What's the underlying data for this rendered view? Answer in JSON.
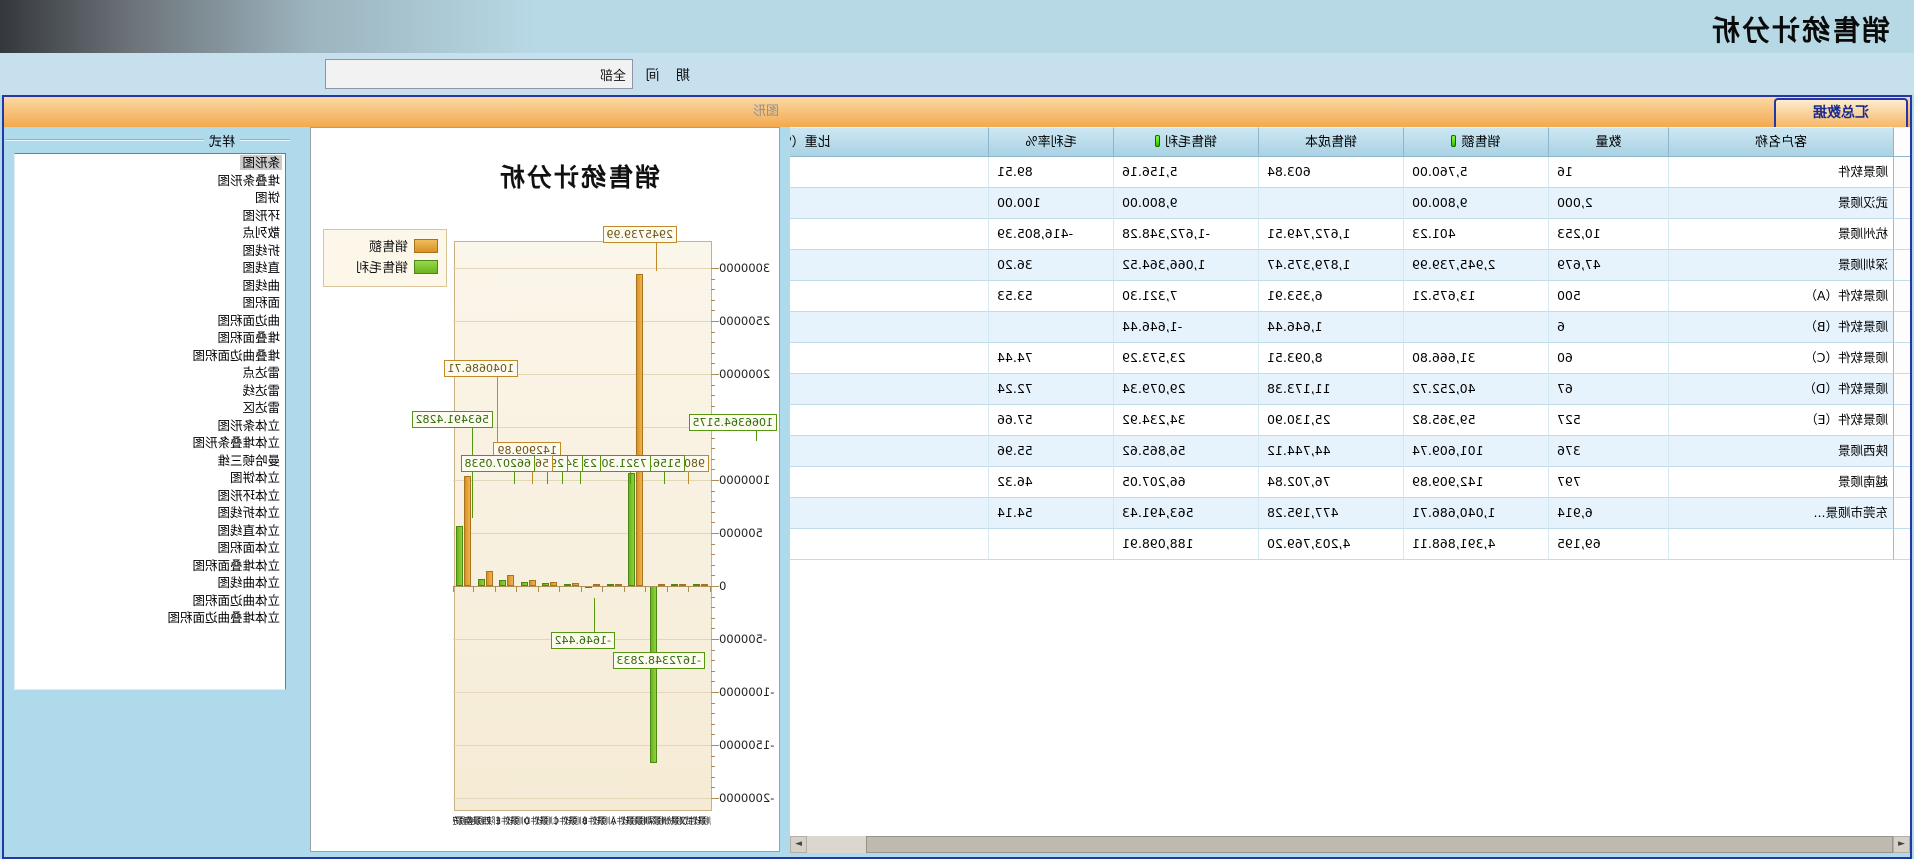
{
  "window": {
    "title": "销售统计分析"
  },
  "toolbar": {
    "period_label": "期 间",
    "period_value": "全部"
  },
  "tabs": {
    "active": "汇总数据",
    "disabled": "图形"
  },
  "scrollbar": {
    "left_arrow": "◄",
    "right_arrow": "►"
  },
  "table": {
    "columns": [
      {
        "label": "客户名称",
        "icon": false
      },
      {
        "label": "数量",
        "icon": false
      },
      {
        "label": "销售额",
        "icon": true
      },
      {
        "label": "销售成本",
        "icon": false
      },
      {
        "label": "销售毛利",
        "icon": true
      },
      {
        "label": "毛利率%",
        "icon": false
      },
      {
        "label": "比重（%）",
        "icon": false
      }
    ],
    "rows": [
      [
        "顺景软件",
        "16",
        "5,760.00",
        "603.84",
        "5,156.16",
        "89.51",
        ""
      ],
      [
        "武汉顺景",
        "2,000",
        "9,800.00",
        "",
        "9,800.00",
        "100.00",
        ""
      ],
      [
        "杭州顺景",
        "10,253",
        "401.23",
        "1,672,749.51",
        "-1,672,348.28",
        "-416,805.39",
        ""
      ],
      [
        "深圳顺景",
        "47,679",
        "2,945,739.99",
        "1,879,375.47",
        "1,066,364.52",
        "36.20",
        ""
      ],
      [
        "顺景软件（A）",
        "500",
        "13,675.21",
        "6,353.91",
        "7,321.30",
        "53.53",
        ""
      ],
      [
        "顺景软件（B）",
        "6",
        "",
        "1,646.44",
        "-1,646.44",
        "",
        ""
      ],
      [
        "顺景软件（C）",
        "60",
        "31,666.80",
        "8,093.51",
        "23,573.29",
        "74.44",
        ""
      ],
      [
        "顺景软件（D）",
        "67",
        "40,252.72",
        "11,173.38",
        "29,079.34",
        "72.24",
        ""
      ],
      [
        "顺景软件（E）",
        "527",
        "59,365.82",
        "25,130.90",
        "34,234.92",
        "57.66",
        ""
      ],
      [
        "陕西顺景",
        "376",
        "101,609.74",
        "44,744.12",
        "56,865.62",
        "55.96",
        ""
      ],
      [
        "越南顺景",
        "797",
        "142,909.89",
        "76,702.84",
        "66,207.05",
        "46.32",
        ""
      ],
      [
        "东莞市顺景...",
        "6,914",
        "1,040,686.71",
        "477,195.28",
        "563,491.43",
        "54.14",
        ""
      ],
      [
        "",
        "69,195",
        "4,391,868.11",
        "4,203,769.20",
        "188,098.91",
        "",
        ""
      ]
    ]
  },
  "style_panel": {
    "caption": "样式",
    "selected_index": 0,
    "items": [
      "条形图",
      "堆叠条形图",
      "饼图",
      "环形图",
      "散列点",
      "折线图",
      "直线图",
      "曲线图",
      "面积图",
      "曲边面积图",
      "堆叠面积图",
      "堆叠曲边面积图",
      "雷达点",
      "雷达线",
      "雷达区",
      "立体条形图",
      "立体堆叠条形图",
      "曼哈顿三维",
      "立体饼图",
      "立体环形图",
      "立体折线图",
      "立体直线图",
      "立体面积图",
      "立体堆叠面积图",
      "立体曲线图",
      "立体曲边面积图",
      "立体堆叠曲边面积图"
    ]
  },
  "chart_data": {
    "type": "bar",
    "title": "销售统计分析",
    "legend_position": "top-right",
    "grid": true,
    "ylim": [
      -2000000,
      3000000
    ],
    "y_ticks": [
      3000000,
      2500000,
      2000000,
      1500000,
      1000000,
      500000,
      0,
      -500000,
      -1000000,
      -1500000,
      -2000000
    ],
    "categories": [
      "顺景软件",
      "武汉顺景",
      "杭州顺景",
      "深圳顺景",
      "顺景软件（A）",
      "顺景软件（B）",
      "顺景软件（C）",
      "顺景软件（D）",
      "顺景软件（E）",
      "陕西顺景",
      "越南顺景",
      "东莞市顺景"
    ],
    "series": [
      {
        "name": "销售额",
        "color": "#e2a13c",
        "values": [
          5760,
          9800,
          401.23,
          2945739.99,
          13675.21,
          0,
          31666.8,
          40252.72,
          59365.82,
          101609.74,
          142909.89,
          1040686.71
        ]
      },
      {
        "name": "销售毛利",
        "color": "#7cc32d",
        "values": [
          5156.16,
          9800,
          -1672348.28,
          1066364.52,
          7321.3,
          -1646.44,
          23573.29,
          29079.34,
          34234.92,
          56865.62,
          66207.05,
          563491.43
        ]
      }
    ],
    "point_labels": [
      {
        "text": "2945739.99",
        "c": "o",
        "x": 34,
        "y": -16,
        "stem": 30
      },
      {
        "text": "1066364.5175",
        "c": "g",
        "x": -66,
        "y": 172,
        "stem": 12
      },
      {
        "text": "1040686.71",
        "c": "o",
        "x": 193,
        "y": 118,
        "stem": 88
      },
      {
        "text": "563491.4282",
        "c": "g",
        "x": 218,
        "y": 169,
        "stem": 92
      },
      {
        "text": "142909.89",
        "c": "o",
        "x": 150,
        "y": 200,
        "stem": 0
      },
      {
        "text": "9800",
        "c": "o",
        "x": 2,
        "y": 213,
        "stem": 14
      },
      {
        "text": "5156.16",
        "c": "g",
        "x": 26,
        "y": 213,
        "stem": 14
      },
      {
        "text": "7321.30",
        "c": "g",
        "x": 60,
        "y": 213,
        "stem": 14
      },
      {
        "text": "23573.29",
        "c": "g",
        "x": 110,
        "y": 213,
        "stem": 14
      },
      {
        "text": "34234.92",
        "c": "g",
        "x": 128,
        "y": 213,
        "stem": 14
      },
      {
        "text": "29079.34",
        "c": "g",
        "x": 143,
        "y": 213,
        "stem": 14
      },
      {
        "text": "56865.62",
        "c": "o",
        "x": 158,
        "y": 213,
        "stem": 14
      },
      {
        "text": "66207.0538",
        "c": "g",
        "x": 176,
        "y": 213,
        "stem": 14
      },
      {
        "text": "-1646.442",
        "c": "g",
        "x": 96,
        "y": 390,
        "stem": -34
      },
      {
        "text": "-1672348.2833",
        "c": "g",
        "x": 6,
        "y": 410,
        "stem": 0
      }
    ]
  },
  "colors": {
    "accent_navy": "#2636a4",
    "tab_orange": "#f3a94e",
    "panel_blue": "#aedaeb",
    "series_sales": "#e2a13c",
    "series_profit": "#7cc32d"
  }
}
